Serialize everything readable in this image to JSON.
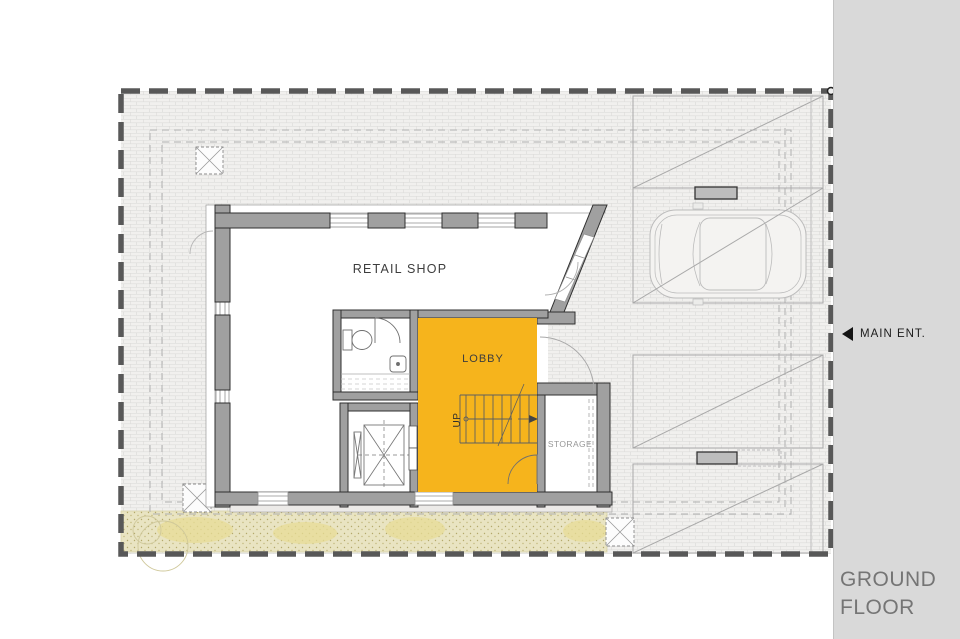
{
  "sidebar": {
    "main_entrance": {
      "label": "MAIN ENT."
    },
    "floor_title": {
      "line1": "GROUND",
      "line2": "FLOOR"
    }
  },
  "plan": {
    "rooms": {
      "retail_shop": "RETAIL SHOP",
      "lobby": "LOBBY",
      "storage": "STORAGE"
    },
    "stairs": {
      "direction_label": "UP"
    },
    "colors": {
      "lobby_highlight": "#f6b41c",
      "wall_fill": "#a0a0a0",
      "wall_stroke": "#2f2f2f",
      "boundary_line": "#585858",
      "site_brick_bg": "#f1f0ee",
      "landscape_band": "#e9e4c2",
      "sidebar_bg": "#d9d9d9",
      "label_dark": "#3d3d3d",
      "label_muted": "#979797"
    }
  }
}
